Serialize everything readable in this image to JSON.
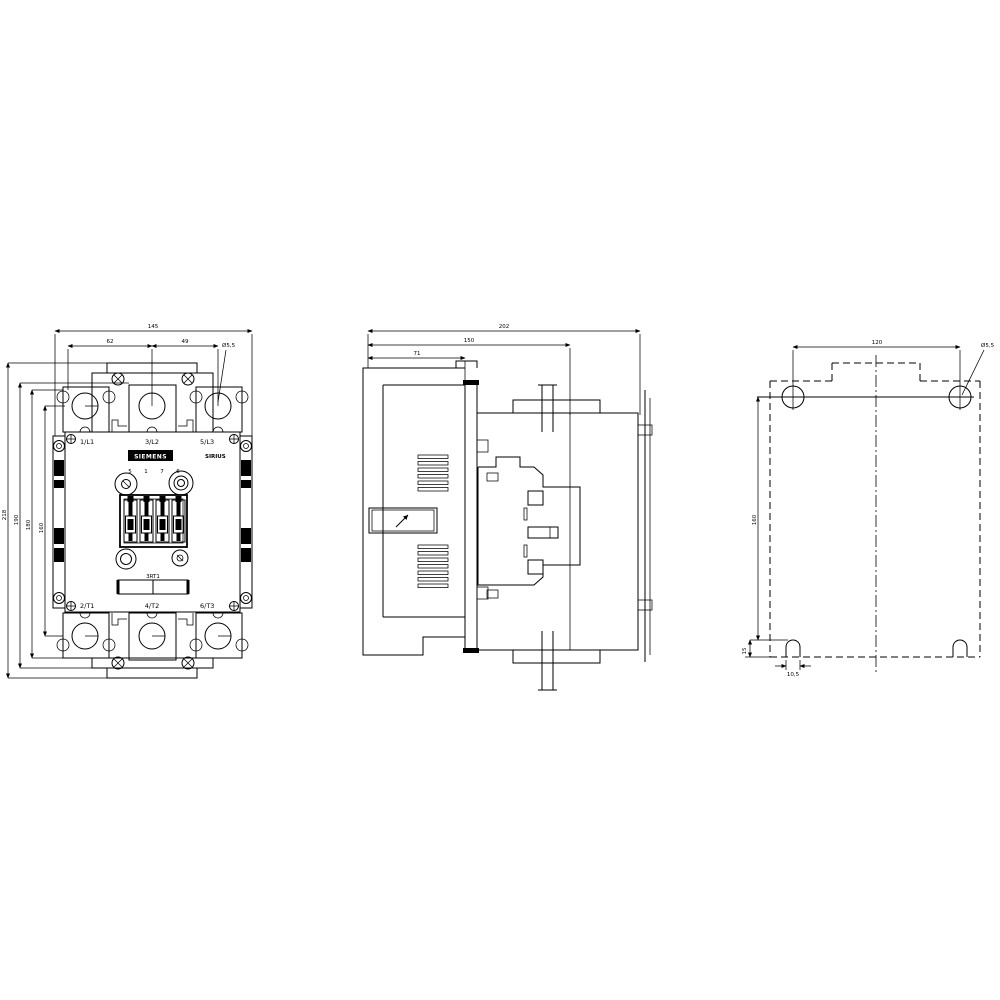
{
  "title": "Contactor dimension drawing",
  "front_view": {
    "dim_width": "145",
    "dim_left": "62",
    "dim_pitch": "49",
    "hole_callout": "Ø5,5",
    "dim_h1": "218",
    "dim_h2": "190",
    "dim_h3": "180",
    "dim_h4": "160",
    "terminals_top": [
      "1/L1",
      "3/L2",
      "5/L3"
    ],
    "terminals_bottom": [
      "2/T1",
      "4/T2",
      "6/T3"
    ],
    "brand": "SIEMENS",
    "series": "SIRIUS",
    "type_label": "3RT1",
    "aux_numbers": [
      "5",
      "1",
      "7",
      "6"
    ]
  },
  "side_view": {
    "dim_depth": "202",
    "dim_mid": "150",
    "dim_front": "71"
  },
  "drill_plan": {
    "dim_hole_spacing_h": "120",
    "hole_callout": "Ø5,5",
    "dim_hole_spacing_v": "160",
    "dim_slot_offset": "15",
    "dim_slot_width": "10,5"
  }
}
